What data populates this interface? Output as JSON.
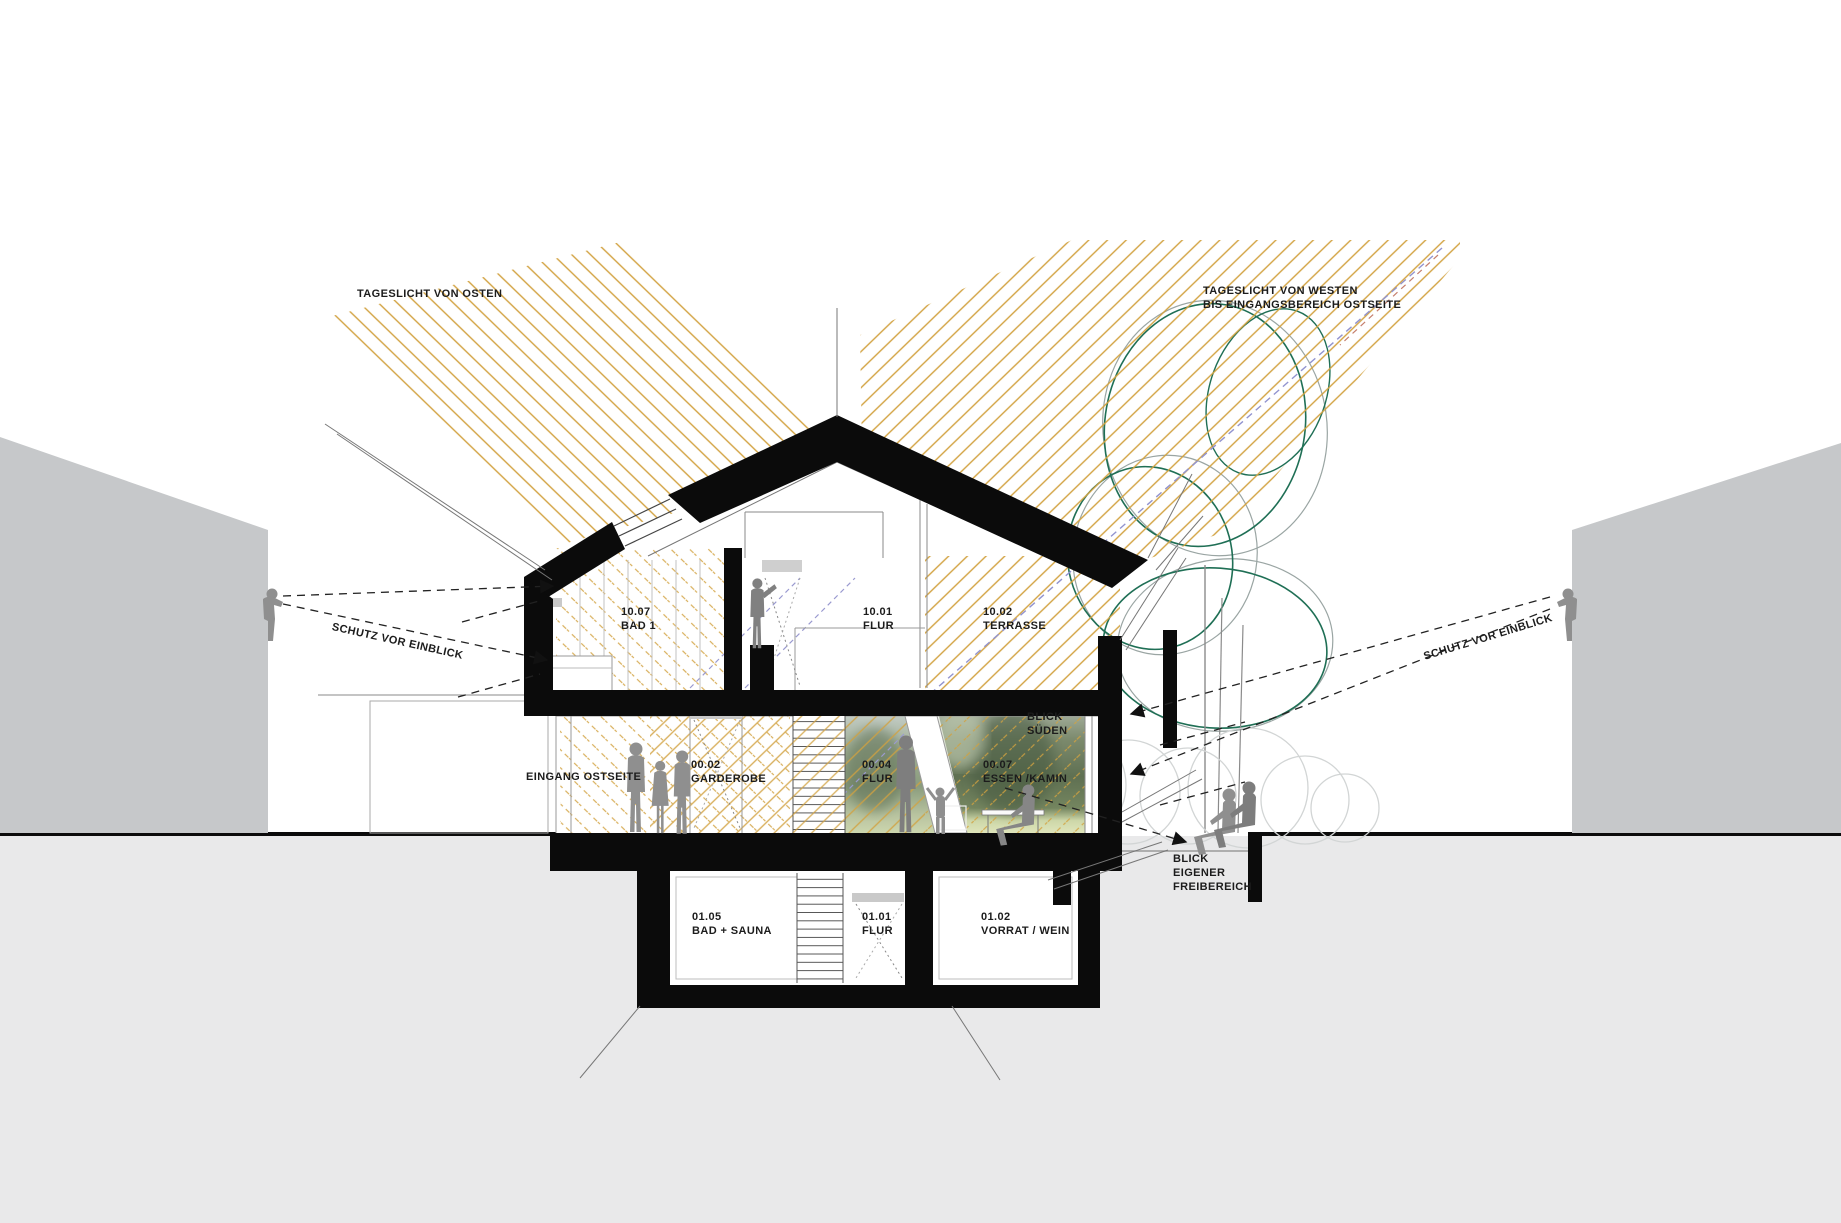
{
  "diagram": {
    "type": "architectural-section",
    "annotations": {
      "daylight_east": "TAGESLICHT VON OSTEN",
      "daylight_west_line1": "TAGESLICHT VON WESTEN",
      "daylight_west_line2": "BIS EINGANGSBEREICH OSTSEITE",
      "privacy_left": "SCHUTZ VOR EINBLICK",
      "privacy_right": "SCHUTZ VOR EINBLICK",
      "entrance": "EINGANG OSTSEITE",
      "view_south_line1": "BLICK",
      "view_south_line2": "SÜDEN",
      "view_private_line1": "BLICK",
      "view_private_line2": "EIGENER",
      "view_private_line3": "FREIBEREICH"
    },
    "rooms": [
      {
        "id": "10.07",
        "name": "BAD 1"
      },
      {
        "id": "10.01",
        "name": "FLUR"
      },
      {
        "id": "10.02",
        "name": "TERRASSE"
      },
      {
        "id": "00.02",
        "name": "GARDEROBE"
      },
      {
        "id": "00.04",
        "name": "FLUR"
      },
      {
        "id": "00.07",
        "name": "ESSEN /KAMIN"
      },
      {
        "id": "01.05",
        "name": "BAD + SAUNA"
      },
      {
        "id": "01.01",
        "name": "FLUR"
      },
      {
        "id": "01.02",
        "name": "VORRAT / WEIN"
      }
    ],
    "colors": {
      "ray_yellow": "#d2a240",
      "ray_blue": "#9193cf",
      "ray_red": "#c57f6d",
      "tree_green": "#1f6f55",
      "tree_gray": "#9aa5a3",
      "shrub_gray": "#d2d5d5",
      "building_gray": "#c6c8ca",
      "ground_gray": "#e9e9ea",
      "structure_black": "#0b0b0b",
      "silhouette_gray": "#8f8f8f",
      "sight_line": "#222222"
    }
  }
}
